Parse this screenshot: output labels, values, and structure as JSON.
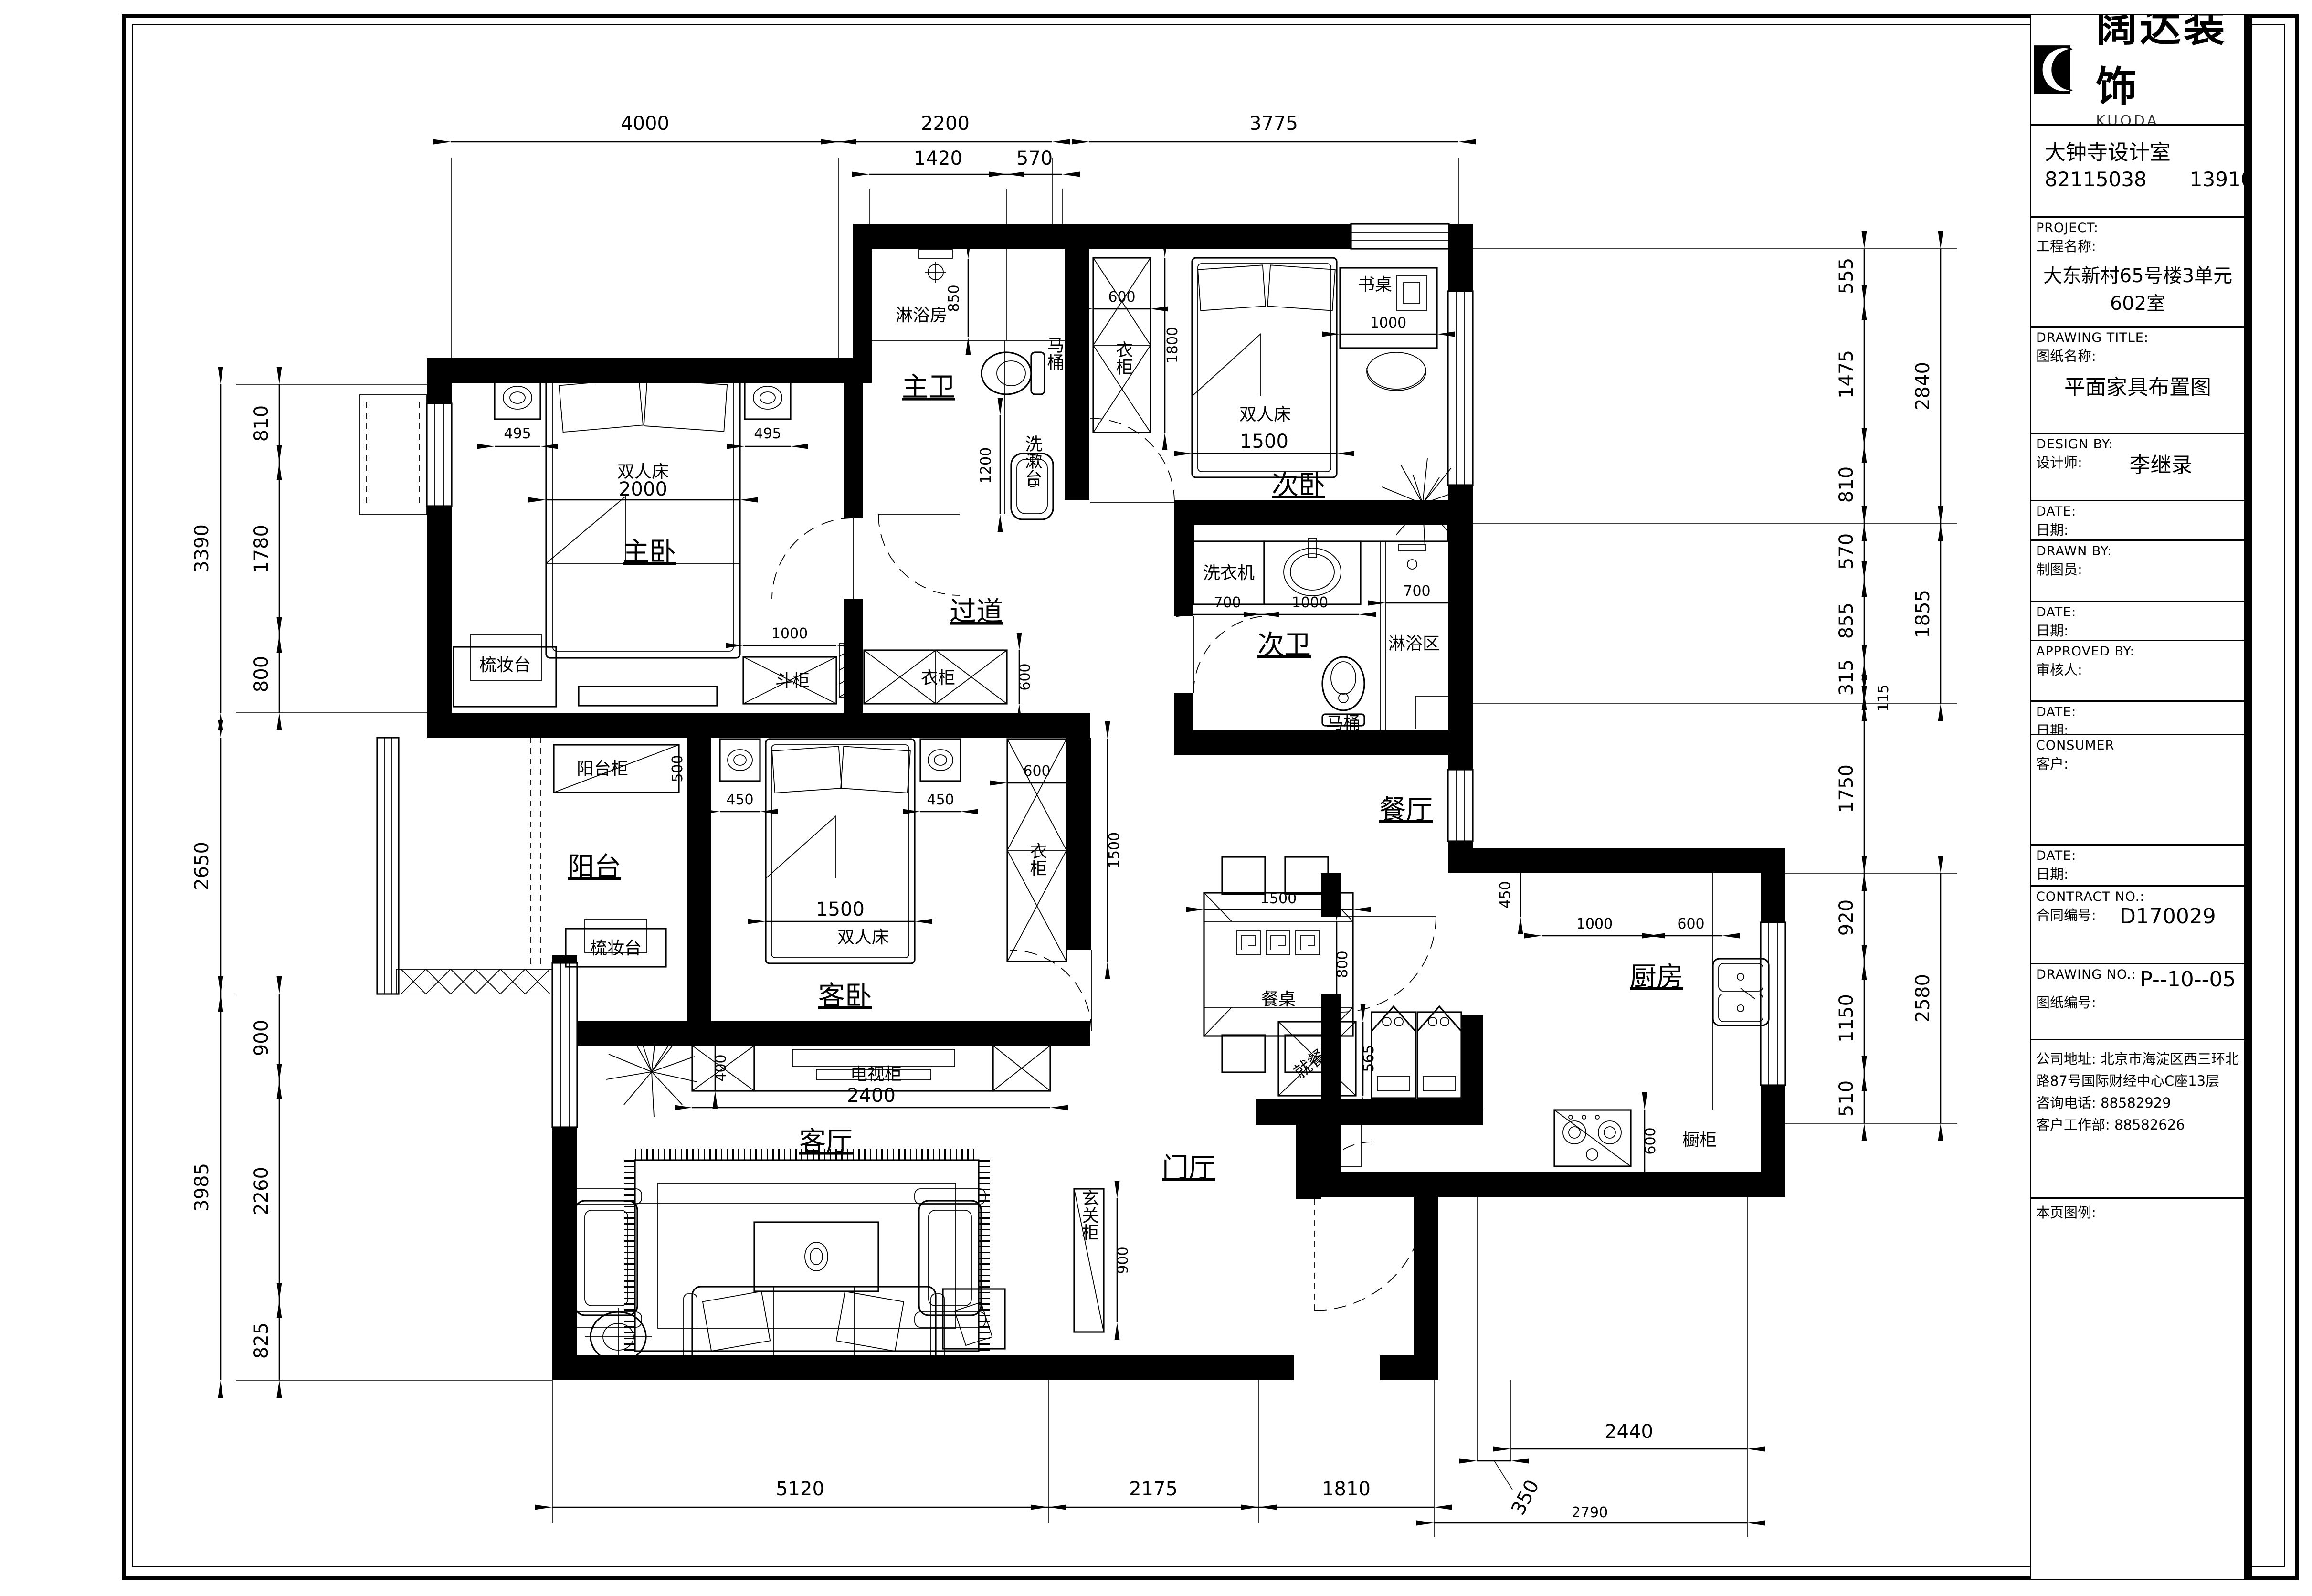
{
  "tb": {
    "logo_cn": "阔达装饰",
    "logo_en": "KUODA DECORRTION",
    "studio": "大钟寺设计室",
    "tel1": "82115038",
    "tel2": "13910138513",
    "project_en": "PROJECT:",
    "project_cn": "工程名称:",
    "project_val": "大东新村65号楼3单元602室",
    "dtitle_en": "DRAWING TITLE:",
    "dtitle_cn": "图纸名称:",
    "dtitle_val": "平面家具布置图",
    "design_en": "DESIGN BY:",
    "design_cn": "设计师:",
    "design_val": "李继录",
    "date_en": "DATE:",
    "date_cn": "日期:",
    "drawn_en": "DRAWN BY:",
    "drawn_cn": "制图员:",
    "appr_en": "APPROVED BY:",
    "appr_cn": "审核人:",
    "cons_en": "CONSUMER",
    "cons_cn": "客户:",
    "contract_en": "CONTRACT NO.:",
    "contract_cn": "合同编号:",
    "contract_val": "D170029",
    "dno_en": "DRAWING NO.:",
    "dno_cn": "图纸编号:",
    "dno_val": "P--10--05",
    "addr1": "公司地址: 北京市海淀区西三环北",
    "addr2": "路87号国际财经中心C座13层",
    "addr3": "咨询电话: 88582929",
    "addr4": "客户工作部: 88582626",
    "legend": "本页图例:"
  },
  "rooms": {
    "master": "主卧",
    "master_bath": "主卫",
    "shower_room": "淋浴房",
    "corridor": "过道",
    "bedroom2": "次卧",
    "bath2": "次卫",
    "shower_area": "淋浴区",
    "balcony": "阳台",
    "guest": "客卧",
    "living": "客厅",
    "dining": "餐厅",
    "kitchen": "厨房",
    "foyer": "门厅"
  },
  "furn": {
    "double_bed": "双人床",
    "dresser": "梳妆台",
    "chest": "斗柜",
    "wardrobe": "衣柜",
    "toilet": "马桶",
    "basin": "洗漱台",
    "washer": "洗衣机",
    "desk": "书桌",
    "balcony_cabinet": "阳台柜",
    "tv_cabinet": "电视柜",
    "dining_table": "餐桌",
    "dining_cabinet": "就餐柜",
    "cupboard": "橱柜",
    "entry_cabinet": "玄关柜"
  },
  "dims": {
    "top": [
      "4000",
      "2200",
      "3775"
    ],
    "top2": [
      "1420",
      "570"
    ],
    "left": [
      "3390",
      "2650",
      "3985"
    ],
    "leftIn": [
      "810",
      "1780",
      "800",
      "900",
      "2260",
      "825"
    ],
    "right": [
      "555",
      "1475",
      "810",
      "570",
      "855",
      "315",
      "115",
      "1750",
      "920",
      "1150",
      "510"
    ],
    "rightOut": [
      "2840",
      "1855",
      "2580"
    ],
    "bottom": [
      "5120",
      "2175",
      "1810"
    ],
    "bottom2": "2790",
    "kitBottom": [
      "350",
      "2440"
    ],
    "m495": "495",
    "m2000": "2000",
    "m1000": "1000",
    "m600": "600",
    "shower850": "850",
    "basin1200": "1200",
    "w600": "600",
    "w1800": "1800",
    "desk1000": "1000",
    "bed1500": "1500",
    "b700": "700",
    "b1000": "1000",
    "bal500": "500",
    "g450": "450",
    "g1500": "1500",
    "gw600": "600",
    "tv2400": "2400",
    "tv400": "400",
    "dt1500": "1500",
    "dt800": "800",
    "dc565": "565",
    "k450": "450",
    "k1000": "1000",
    "k600": "600",
    "kd600": "600",
    "e900": "900"
  }
}
